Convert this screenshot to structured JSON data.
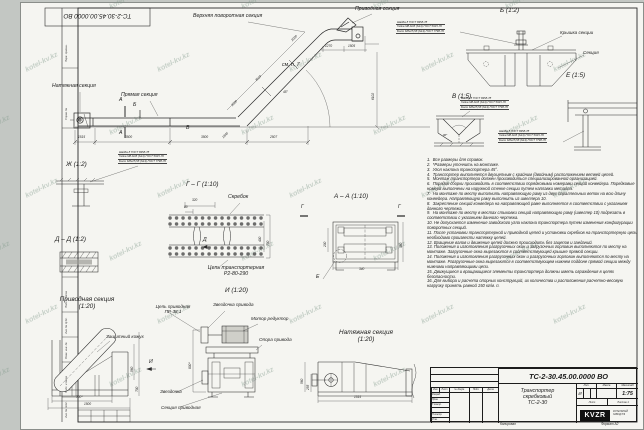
{
  "watermark": {
    "text": "kotel-kv.kz"
  },
  "stamp_top_left": "ТС-2-30.45.00.0000  ВО",
  "main_view": {
    "labels": {
      "upper_turn_section": "Верхняя поворотная секция",
      "drive_section": "Приводная секция",
      "tension_section": "Натяжная секция",
      "straight_section": "Прямая секция",
      "see_note": "см. п. 7"
    },
    "dims": {
      "seg1": "1515",
      "seg2": "3500",
      "seg3": "3500",
      "seg4": "2507",
      "diag": "1845",
      "inc1": "2000",
      "inc2": "3519",
      "inc3": "2000",
      "top1": "1270",
      "top2": "1505",
      "height": "6102",
      "angle": "45°"
    }
  },
  "marks": {
    "a": "А",
    "b": "Б",
    "v": "В",
    "g": "Г",
    "d": "Д",
    "e": "Е",
    "i": "И"
  },
  "fastener_note": [
    "Шайба 8 ГОСТ 6958-78",
    "Гайка М8-6Н5 (S13) ГОСТ 5915-70",
    "Болт М8х25,58 (S13) ГОСТ 7798-70"
  ],
  "views": {
    "zh": {
      "title": "Ж  (1:2)"
    },
    "b": {
      "title": "Б  (1:2)",
      "cover": "Крышка секции",
      "section": "Секция"
    },
    "v": {
      "title": "В  (1:5)",
      "angle": "90*"
    },
    "e": {
      "title": "Е  (1:5)"
    },
    "gg": {
      "title": "Г – Г  (1:10)",
      "scraper": "Скребок",
      "chain": "Цепь транспортерная\nР2-80-290",
      "dims": {
        "w": "320",
        "w2": "80",
        "h_outer": "700",
        "h_inner": "400"
      }
    },
    "aa": {
      "title": "А – А  (1:10)",
      "dims": {
        "left": "200",
        "right": "380",
        "bottom": "340"
      }
    },
    "dd": {
      "title": "Д – Д  (1:2)"
    },
    "drive20": {
      "title": "Приводная секция\n(1:20)",
      "casing": "Защитный кожух",
      "dims": {
        "b1": "700*",
        "b2": "1500",
        "r1": "560",
        "r2": "700"
      }
    },
    "i20": {
      "title": "И  (1:20)",
      "drive_chain": "Цепь приводная\nПР-38,1",
      "drive_sprocket": "Звездочка привода",
      "motor": "Мотор редуктор",
      "support": "Опора привода",
      "sprocket": "Звездочка",
      "drive_sec": "Секция приводная",
      "dim": "800*"
    },
    "tension20": {
      "title": "Натяжная секция\n(1:20)",
      "dims": {
        "len": "1515",
        "l1": "560",
        "l2": "255"
      }
    }
  },
  "notes": {
    "lines": [
      "1.  Все размеры для справок.",
      "2.  *Размеры уточнить на монтаже.",
      "3.  Угол наклона транспортера 45°.",
      "4.  Транспортер выполняется двухцепным с крайним (двойным) расположением ветвей цепей.",
      "5.  Монтаж транспортера должен производиться специализированной организацией.",
      "6.  Порядок сборки производить в соответствии порядковыми номерами секций конвейера. Порядковые номера выполнены на наружной стенке секции путем наплавки металла.",
      "7.  На монтаже по месту выполнить направляющую раму из двух параллельных веток на всю длину конвейера. Направляющую раму выполнить из швеллера 10.",
      "8.  Закрепление секций конвейера на направляющей раме выполняется в соответствии с указанием данного чертежа.",
      "9.  На монтаже по месту в местах стыковки секций направляющую раму (швеллер 10) подрезать в соответствии с указанием данного чертежа.",
      "10. Не допускается изменение заводского угла наклона транспортера путем изменения конфигурации поворотных секций.",
      "11. После установки транспортерной и приводной цепей и установки скребков на транспортерную цепь необходимо произвести натяжку цепей.",
      "12. Вращение валов и движение цепей должно происходить без зацепов и заеданий.",
      "13. Положения и изготовления разгрузочных окон и загрузочных горловин выполняются по месту на монтаже. Загрузочные окна вырезаются в соответствующей крышке прямой секции.",
      "14. Положения и изготовления разгрузочных окон и разгрузочных горловин выполняются по месту на монтаже. Разгрузочные окна вырезаются в соответствующем нижнем поддоне прямой секции между нижними направляющими цепи.",
      "15. Движущиеся и вращающиеся элементы транспортера должны иметь ограждения в целях безопасности.",
      "16. Для выбора и расчета опорных конструкций, их количества и расположения расчетно-весовую нагрузку принять равной 150 кг/м. п."
    ]
  },
  "title_block": {
    "number": "ТС-2-30.45.00.0000  ВО",
    "name": "Транспортер\nскребковый\nТС-2-30",
    "cols": [
      "Изм.",
      "Лист",
      "№ докум.",
      "Подп.",
      "Дата"
    ],
    "rows": [
      "Разраб.",
      "Пров.",
      "Т.контр.",
      "Н.контр.",
      "Утв."
    ],
    "lit_header": "Лит.",
    "mass_header": "Масса",
    "scale_header": "Масштаб",
    "lit_value": "И",
    "scale_value": "1:75",
    "sheet_label": "Лист",
    "sheets_label": "Листов 1",
    "logo": "KVZR",
    "logo_sub": "КОТЕЛЬНЫЙ\nЗАВОД РФ",
    "footer_center": "Копировал",
    "footer_right": "Формат А2"
  },
  "frame_labels": [
    "Инв. № подл.",
    "Подп. и дата",
    "Взам. инв. №",
    "Инв. № дубл.",
    "Подп. и дата",
    "Справ. №",
    "Перв. примен."
  ],
  "colors": {
    "line": "#2a2a2a",
    "sheet": "#f5f5f1",
    "background": "#c3c7c3",
    "watermark": "#829b8c"
  }
}
